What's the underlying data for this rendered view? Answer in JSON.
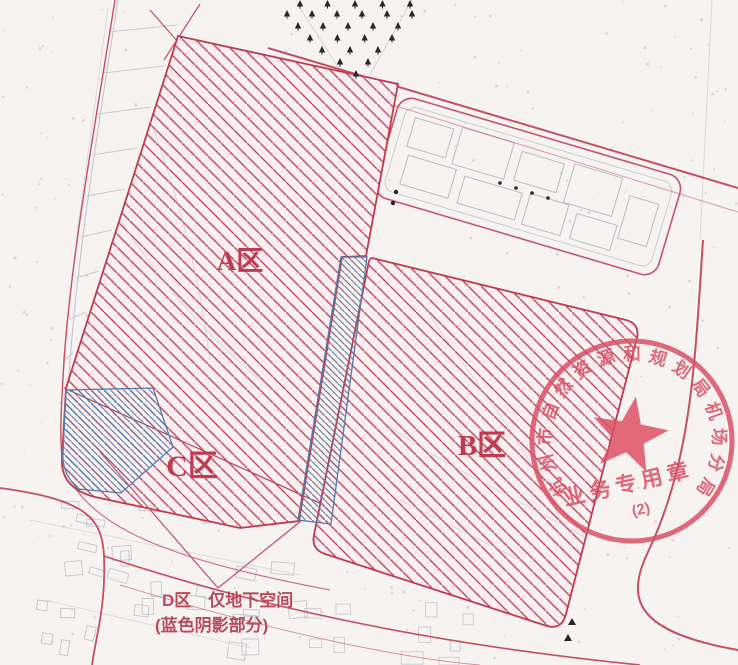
{
  "map": {
    "title_hint": "urban planning red-line map",
    "zones": [
      {
        "id": "A",
        "label": "A区"
      },
      {
        "id": "B",
        "label": "B区"
      },
      {
        "id": "C",
        "label": "C区"
      }
    ],
    "underground_note": {
      "line1": "D区　仅地下空间",
      "line2": "(蓝色阴影部分)"
    },
    "colors": {
      "zone_hatch_red": "#c64a5c",
      "zone_outline_red": "#c03a50",
      "underground_hatch_blue": "#4d7fae",
      "road_line_red": "#c45062",
      "base_linework_gray": "#bcc2cc",
      "tree_symbol_black": "#26262b",
      "stamp_red": "#d94f63",
      "background": "#f7f3f1"
    }
  },
  "stamp": {
    "arc_text": "杭州市自然资源和规划局机场分局",
    "inner_text": "业务专用章",
    "number": "(2)"
  }
}
